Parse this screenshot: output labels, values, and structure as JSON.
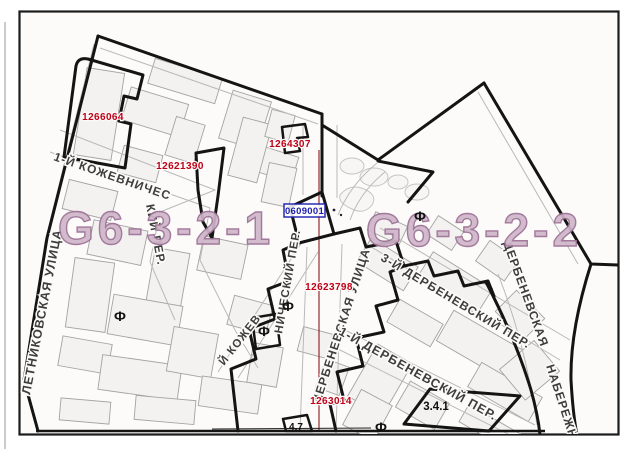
{
  "zones": {
    "left": "G6-3-2-1",
    "right": "G6-3-2-2"
  },
  "parcels": [
    {
      "number": "1266064"
    },
    {
      "number": "12621390"
    },
    {
      "number": "1264307"
    },
    {
      "number": "12623798"
    },
    {
      "number": "1263014"
    }
  ],
  "boundary_point": "0609001",
  "area_labels": {
    "a341": "3.4.1",
    "a47": "4.7"
  },
  "marker_symbol": "Ф",
  "streets": {
    "letnikovskaya": "ЛЕТНИКОВСКАЯ УЛИЦА",
    "kozhevnichesky1_a": "1-Й КОЖЕВНИЧЕС",
    "kozhevnichesky1_b": "КИЙ ПЕР.",
    "kozhevnichesky2_a": "Й КОЖЕВ",
    "kozhevnichesky2_b": "НИЧЕСКИЙ ПЕР.",
    "derbenevskaya_ulitsa": "ДЕРБЕНЕВСКАЯ УЛИЦА",
    "derbenevsky3": "3-Й ДЕРБЕНЕВСКИЙ ПЕР.",
    "derbenevsky1": "1-Й ДЕРБЕНЕВСКИЙ ПЕР.",
    "naberezhnaya_a": "ДЕРБЕНЕВСКАЯ",
    "naberezhnaya_b": "НАБЕРЕЖНАЯ"
  },
  "colors": {
    "parcel_number": "#c00018",
    "boundary_point": "#1c1cae",
    "zone_fill": "#cfb6ca",
    "zone_stroke": "#9c6f94",
    "street_text": "#3d3d3d",
    "boundary_line": "#141414"
  }
}
